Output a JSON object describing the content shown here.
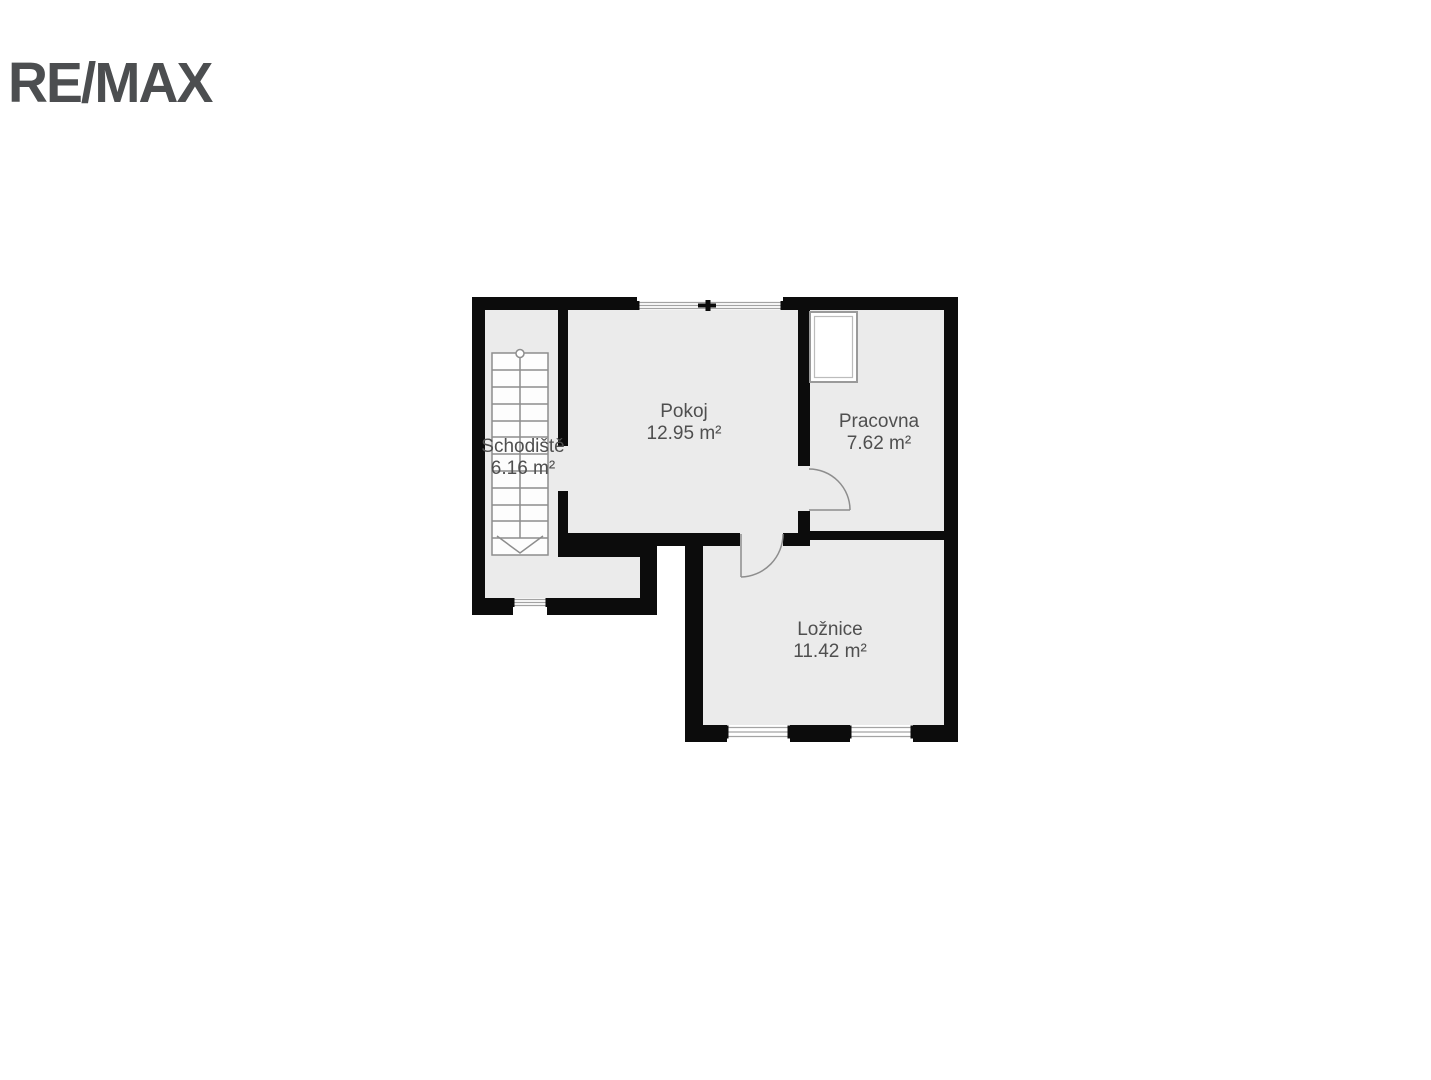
{
  "logo": {
    "text": "RE/MAX",
    "color": "#4c4e50"
  },
  "floor_plan": {
    "rooms": [
      {
        "name": "Schodiště",
        "area": "6.16 m²"
      },
      {
        "name": "Pokoj",
        "area": "12.95 m²"
      },
      {
        "name": "Pracovna",
        "area": "7.62 m²"
      },
      {
        "name": "Ložnice",
        "area": "11.42 m²"
      }
    ],
    "colors": {
      "wall": "#0c0c0c",
      "floor": "#ebebeb",
      "detail_line": "#8d8d8d",
      "label_text": "#4f4f4f",
      "background": "#ffffff"
    }
  }
}
